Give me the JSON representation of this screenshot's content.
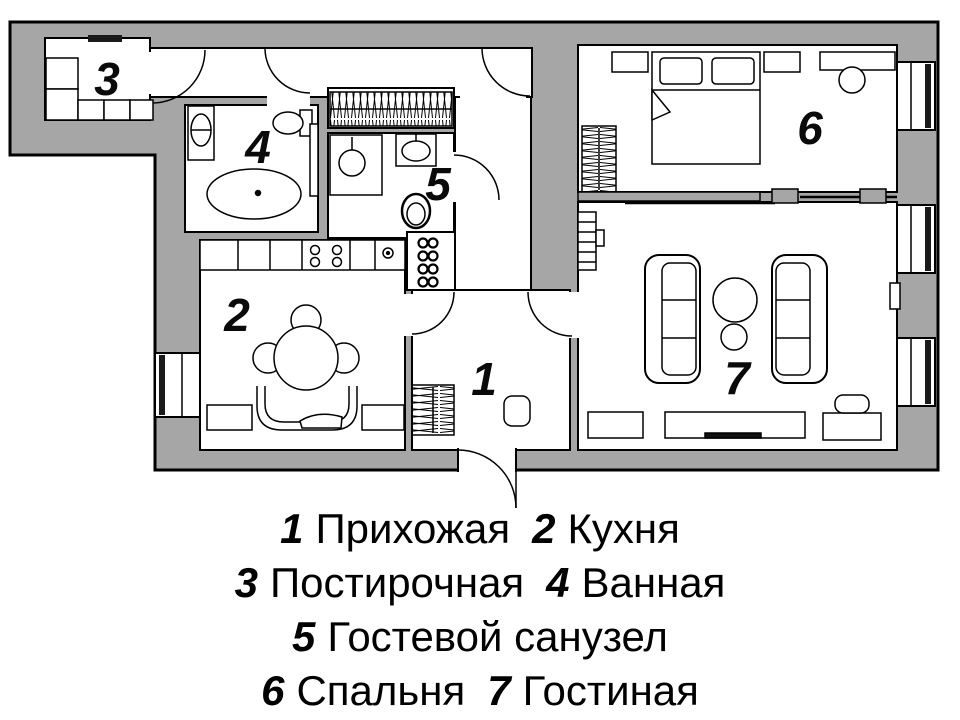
{
  "title": "Apartment floor plan",
  "colors": {
    "wall": "#a6a6a6",
    "outline": "#000000",
    "floor": "#ffffff",
    "window_frame": "#1a1a1a"
  },
  "rooms": [
    {
      "num": "1",
      "name": "Прихожая"
    },
    {
      "num": "2",
      "name": "Кухня"
    },
    {
      "num": "3",
      "name": "Постирочная"
    },
    {
      "num": "4",
      "name": "Ванная"
    },
    {
      "num": "5",
      "name": "Гостевой санузел"
    },
    {
      "num": "6",
      "name": "Спальня"
    },
    {
      "num": "7",
      "name": "Гостиная"
    }
  ],
  "legend": {
    "rows": [
      {
        "items": [
          {
            "num": "1",
            "name": "Прихожая"
          },
          {
            "num": "2",
            "name": "Кухня"
          }
        ]
      },
      {
        "items": [
          {
            "num": "3",
            "name": "Постирочная"
          },
          {
            "num": "4",
            "name": "Ванная"
          }
        ]
      },
      {
        "items": [
          {
            "num": "5",
            "name": "Гостевой санузел"
          }
        ]
      },
      {
        "items": [
          {
            "num": "6",
            "name": "Спальня"
          },
          {
            "num": "7",
            "name": "Гостиная"
          }
        ]
      }
    ]
  }
}
